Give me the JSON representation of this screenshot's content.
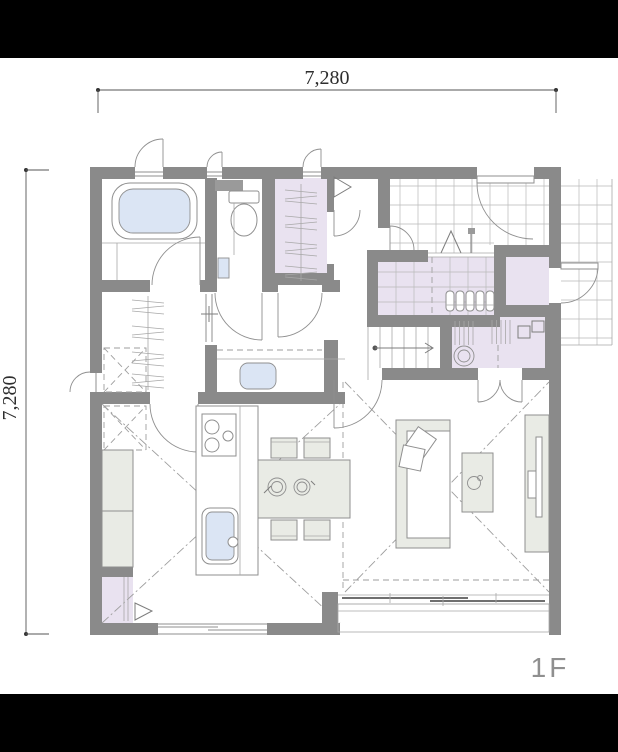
{
  "page": {
    "background": "#ffffff",
    "letterbox_color": "#000000"
  },
  "floor_plan": {
    "floor_label": "1F",
    "dimensions": {
      "top": "7,280",
      "left": "7,280"
    },
    "palette": {
      "wall": "#8a8a8a",
      "room_accent_lavender": "#e9e2f0",
      "water_blue": "#dbe5f4",
      "furniture_gray": "#e9ebe5",
      "line_gray": "#8f8f8f",
      "tile_grid": "#b9b9b9",
      "dimension_text": "#2e2e2e",
      "floor_label_gray": "#8f8f8f"
    },
    "rooms": [
      "bathroom",
      "toilet-room",
      "clothes-closet",
      "washroom",
      "powder-room",
      "hallway",
      "entrance-porch",
      "genkan",
      "shoe-in-closet",
      "outdoor-storage",
      "staircase",
      "kitchen",
      "dining-area",
      "living-room",
      "pantry",
      "wood-deck"
    ],
    "fixtures": [
      "bathtub",
      "toilet",
      "wash-basin",
      "washing-machine-space",
      "hanging-clothes-rod",
      "refrigerator-space",
      "kitchen-island",
      "cooktop",
      "kitchen-sink",
      "dining-table",
      "chairs",
      "sofa",
      "cushions",
      "side-table",
      "tv-board",
      "shoe-cabinet",
      "sliding-glass-door",
      "front-door",
      "casement-windows",
      "stairs-up-arrow"
    ]
  }
}
